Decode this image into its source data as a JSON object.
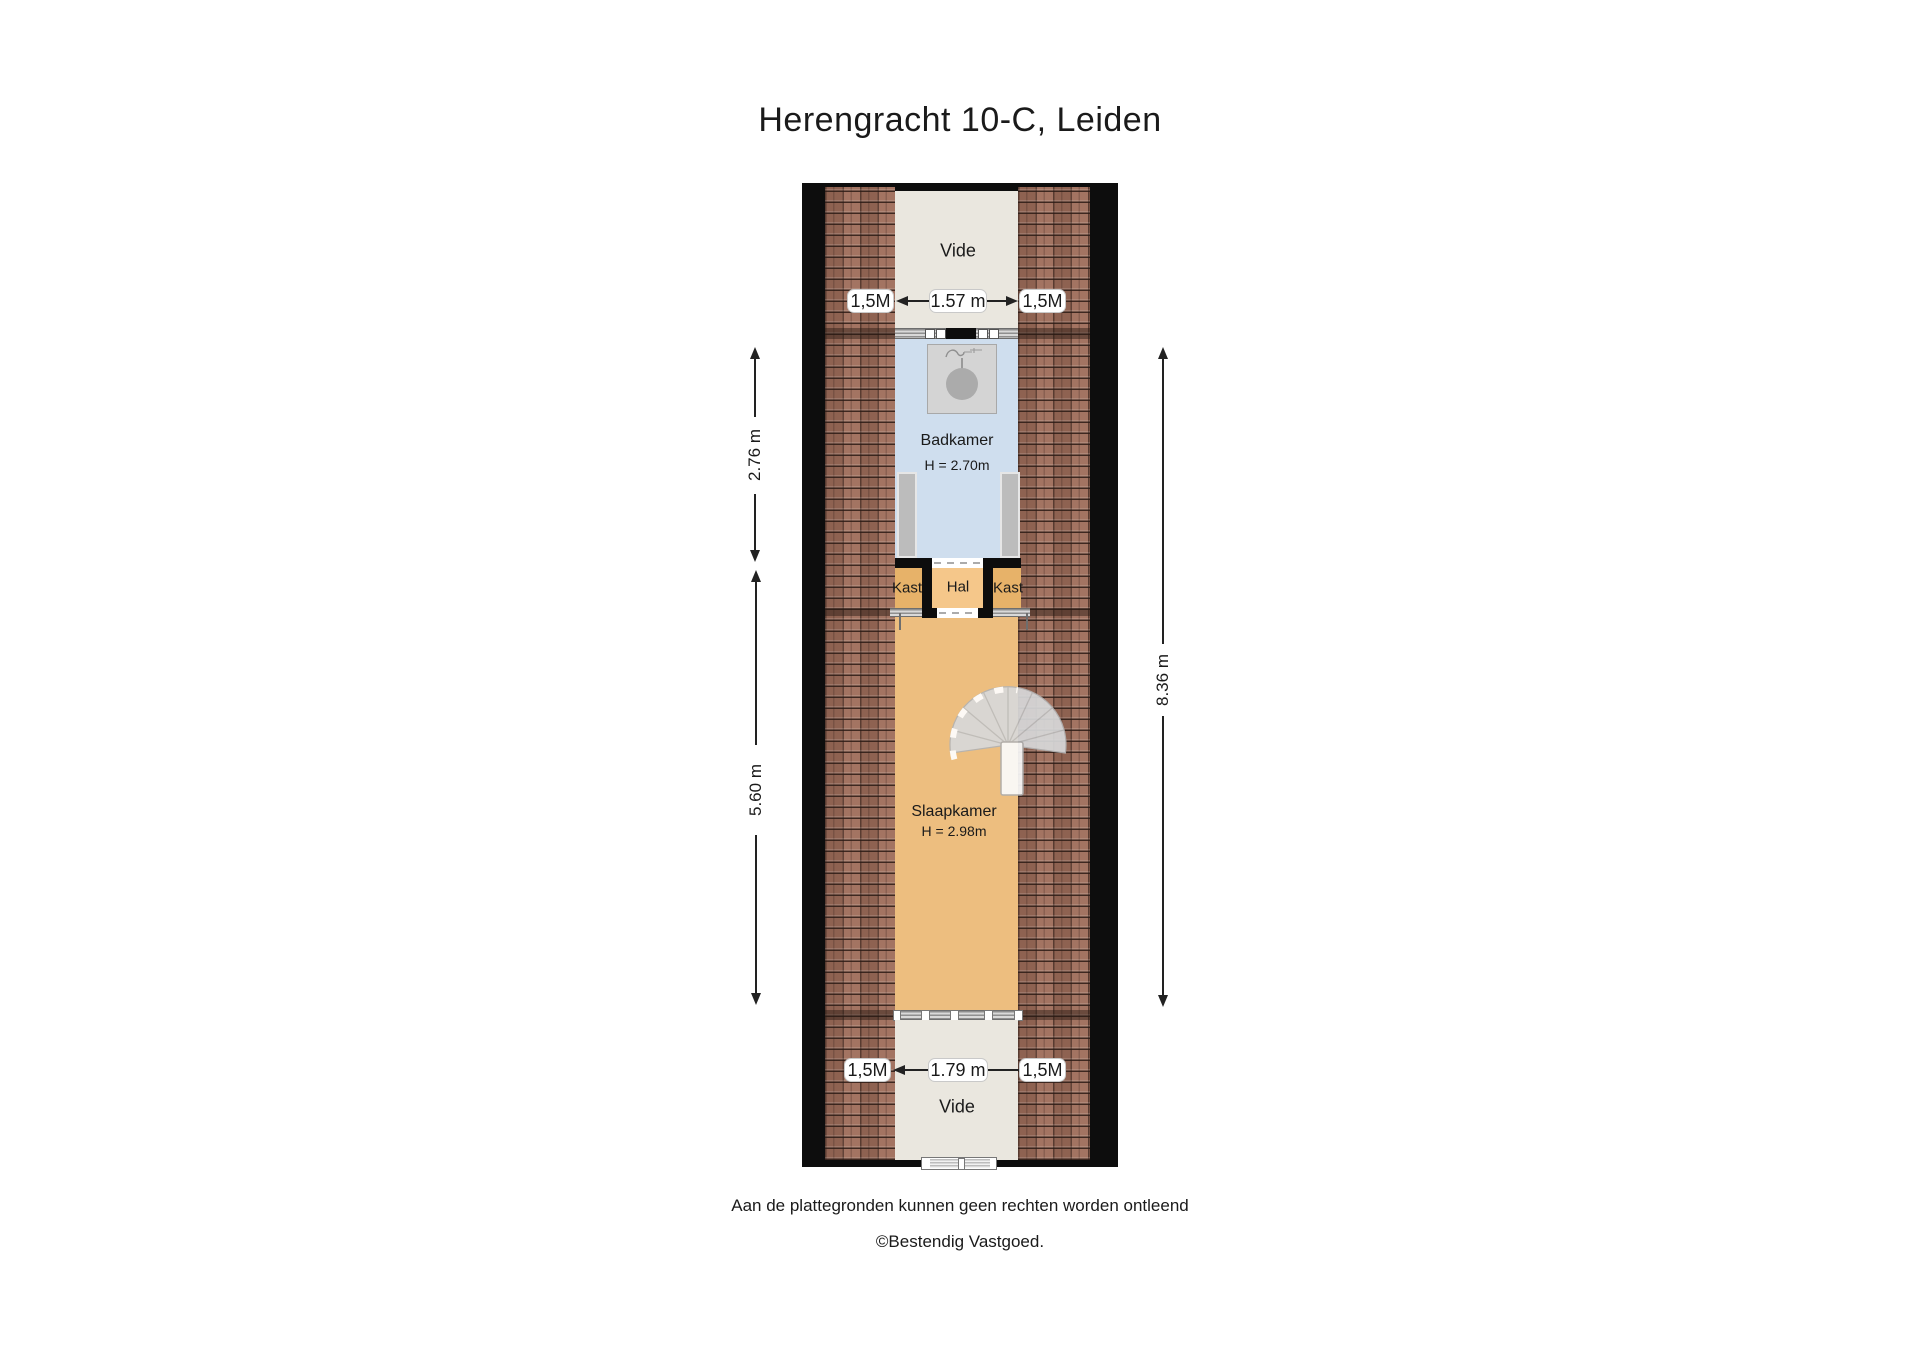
{
  "title": "Herengracht 10-C, Leiden",
  "plan": {
    "rooms": {
      "vide_top": {
        "label": "Vide"
      },
      "badkamer": {
        "label": "Badkamer",
        "height_label": "H = 2.70m"
      },
      "kast_left": {
        "label": "Kast"
      },
      "hal": {
        "label": "Hal"
      },
      "kast_right": {
        "label": "Kast"
      },
      "slaapkamer": {
        "label": "Slaapkamer",
        "height_label": "H = 2.98m"
      },
      "vide_bottom": {
        "label": "Vide"
      }
    },
    "dimensions": {
      "top_left_marker": "1,5M",
      "top_width": "1.57 m",
      "top_right_marker": "1,5M",
      "bottom_left_marker": "1,5M",
      "bottom_width": "1.79 m",
      "bottom_right_marker": "1,5M",
      "left_upper": "2.76 m",
      "left_lower": "5.60 m",
      "right_full": "8.36 m"
    }
  },
  "footer": {
    "disclaimer": "Aan de plattegronden kunnen geen rechten worden ontleend",
    "copyright": "©Bestendig Vastgoed."
  },
  "colors": {
    "text": "#1a1a1a",
    "wall": "#0d0d0d",
    "tile": "#9e6d5a",
    "vide": "#eae7df",
    "badkamer": "#cfdeee",
    "hal": "#f5c78a",
    "kast": "#e7b269",
    "slaapkamer": "#edbe7f",
    "shower": "#d4d4d4",
    "door": "#bcbcbc"
  }
}
